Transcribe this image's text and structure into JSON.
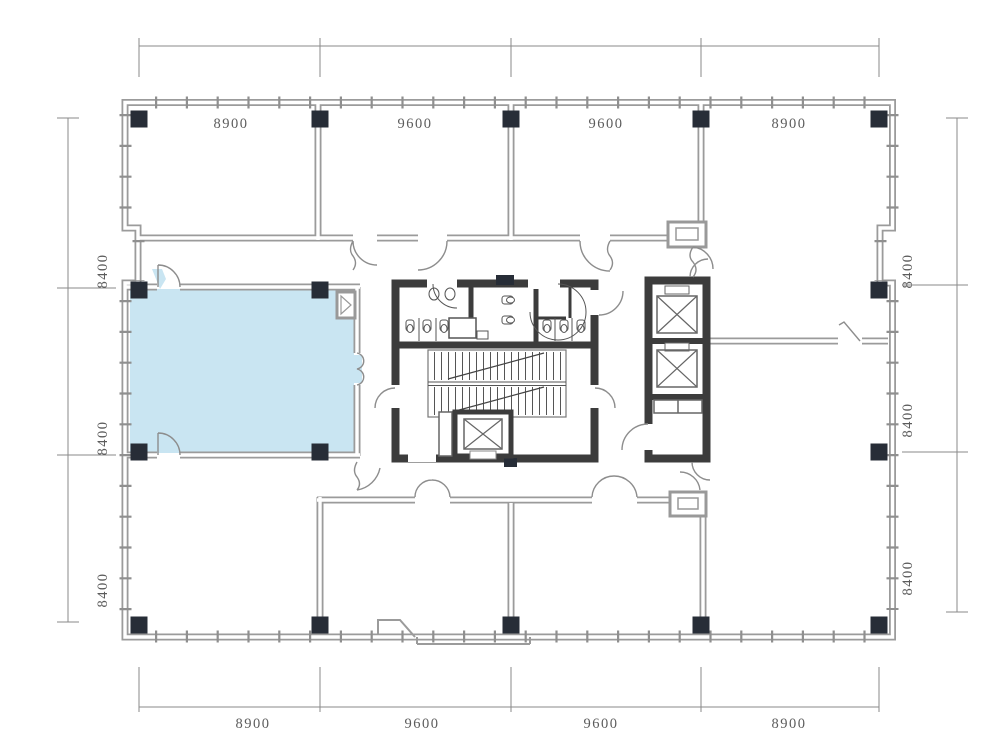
{
  "plan": {
    "colors": {
      "highlight": "#c9e5f2",
      "column": "#272d37",
      "wall": "#9b9b9b",
      "core_wall": "#3c3c3c",
      "dimension_line": "#8a8a8a",
      "dimension_text": "#5c5c5c"
    }
  },
  "dimensions": {
    "top": [
      "8900",
      "9600",
      "9600",
      "8900"
    ],
    "bottom": [
      "8900",
      "9600",
      "9600",
      "8900"
    ],
    "left": [
      "8400",
      "8400",
      "8400"
    ],
    "right": [
      "8400",
      "8400",
      "8400"
    ]
  }
}
